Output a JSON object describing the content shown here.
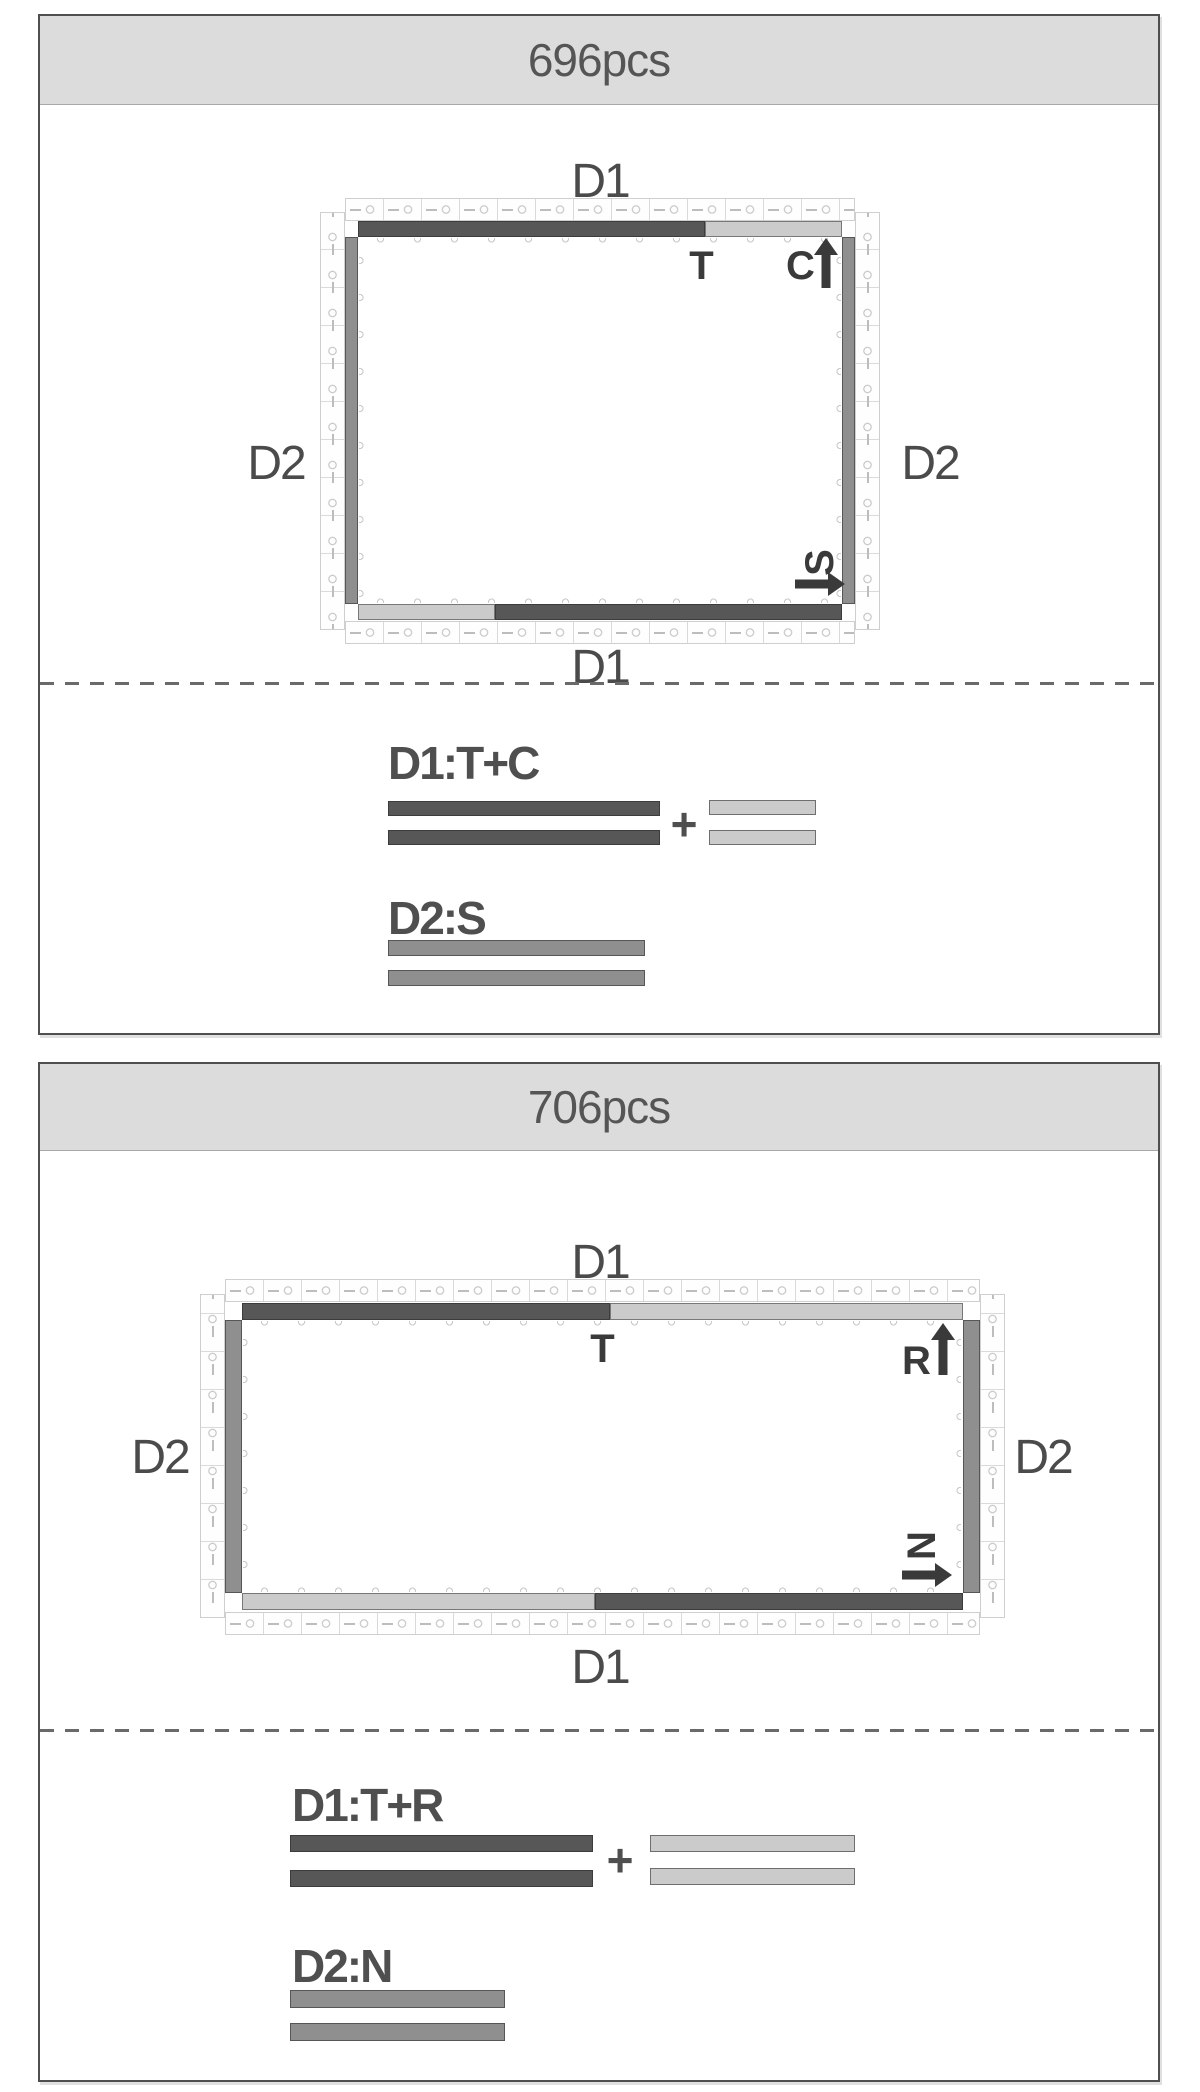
{
  "colors": {
    "dark_piece": "#575757",
    "light_piece": "#cbcbcb",
    "medium_piece": "#8f8f8f",
    "header_bg": "#dcdcdc",
    "panel_border": "#4f4f4f",
    "marker_text": "#3a3a3a",
    "track_outline": "#cfcfcf"
  },
  "panels": [
    {
      "title": "696pcs",
      "diagram": {
        "d1_top": "D1",
        "d1_bottom": "D1",
        "d2_left": "D2",
        "d2_right": "D2",
        "top_dark_marker": "T",
        "top_light_marker": "C",
        "side_marker": "S"
      },
      "legend": {
        "d1_heading": "D1:T+C",
        "plus": "+",
        "d2_heading": "D2:S"
      }
    },
    {
      "title": "706pcs",
      "diagram": {
        "d1_top": "D1",
        "d1_bottom": "D1",
        "d2_left": "D2",
        "d2_right": "D2",
        "top_dark_marker": "T",
        "top_light_marker": "R",
        "side_marker": "N"
      },
      "legend": {
        "d1_heading": "D1:T+R",
        "plus": "+",
        "d2_heading": "D2:N"
      }
    }
  ]
}
